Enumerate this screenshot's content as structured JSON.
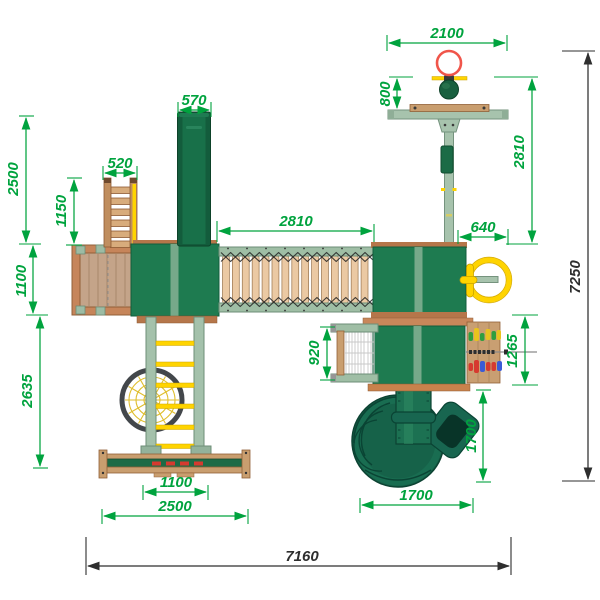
{
  "drawing": {
    "kind": "playground-equipment-top-view-plan",
    "units_implied": "mm"
  },
  "dims": {
    "slide_width": "570",
    "stairs_width": "520",
    "hoop_beam": "2100",
    "hoop_offset": "800",
    "pole_span": "2810",
    "bridge_span": "2810",
    "wheel_offset": "640",
    "left_span_upper": "2500",
    "stairs_span": "1150",
    "deck_span": "1100",
    "swing_span": "2635",
    "net_span": "920",
    "panel_span": "1265",
    "spiral_span_v": "1700",
    "spiral_span_h": "1700",
    "base_inner_span": "1100",
    "base_span": "2500",
    "overall_height": "7250",
    "overall_width": "7160"
  },
  "colors": {
    "dimension_green": "#00A33E",
    "dimension_black": "#2E2E2E",
    "roof_green": "#1E7B50",
    "slide_green": "#135C3C",
    "frame_sage": "#A7C3AD",
    "wood_light": "#C99E6F",
    "wood_dark": "#B5764A",
    "accent_yellow": "#FFD400",
    "hoop_red": "#F0554A",
    "bead_red": "#D63A2F",
    "bead_blue": "#3B5BD6",
    "bead_green": "#2F9E3F"
  },
  "components": [
    "basketball-hoop",
    "swing-beam",
    "straight-slide",
    "access-stairs",
    "wooden-deck",
    "tower-roof",
    "rope-bridge",
    "climbing-net",
    "nest-swing-web",
    "monkey-bar-frame",
    "steering-wheel",
    "abacus-panel",
    "spiral-tube-slide"
  ]
}
